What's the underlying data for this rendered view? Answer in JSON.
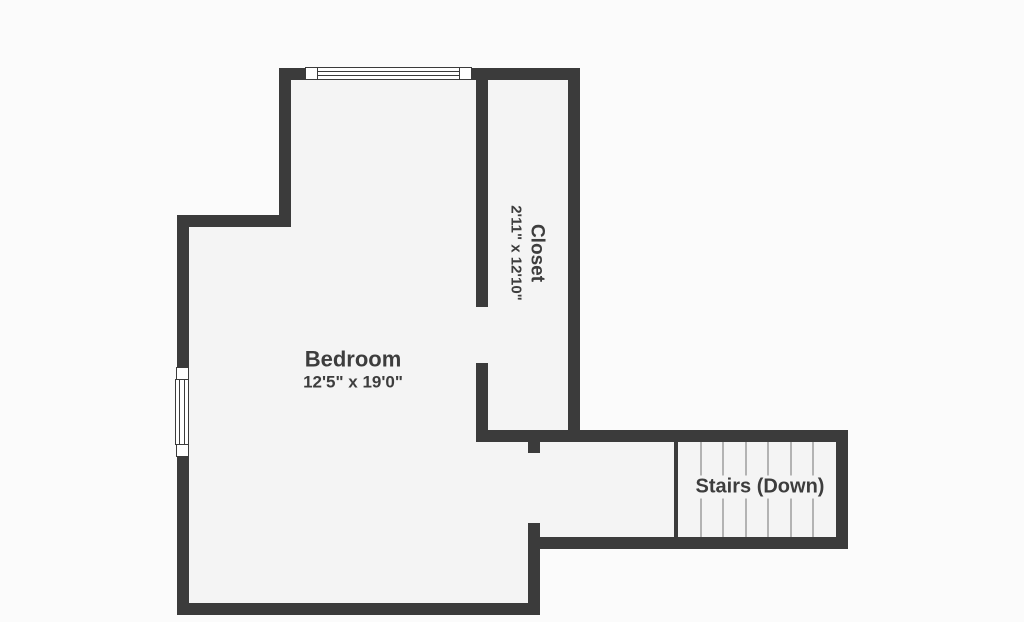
{
  "floorplan": {
    "colors": {
      "background": "#fbfbfb",
      "wall": "#3b3b3b",
      "room_fill": "#f4f4f4",
      "text": "#3d3d3d",
      "stair_tread": "#b3b3b3"
    },
    "bedroom": {
      "name": "Bedroom",
      "dimensions": "12'5\" x 19'0\""
    },
    "closet": {
      "name": "Closet",
      "dimensions": "2'11\" x 12'10\""
    },
    "stairs": {
      "label": "Stairs (Down)",
      "steps": 7
    }
  }
}
